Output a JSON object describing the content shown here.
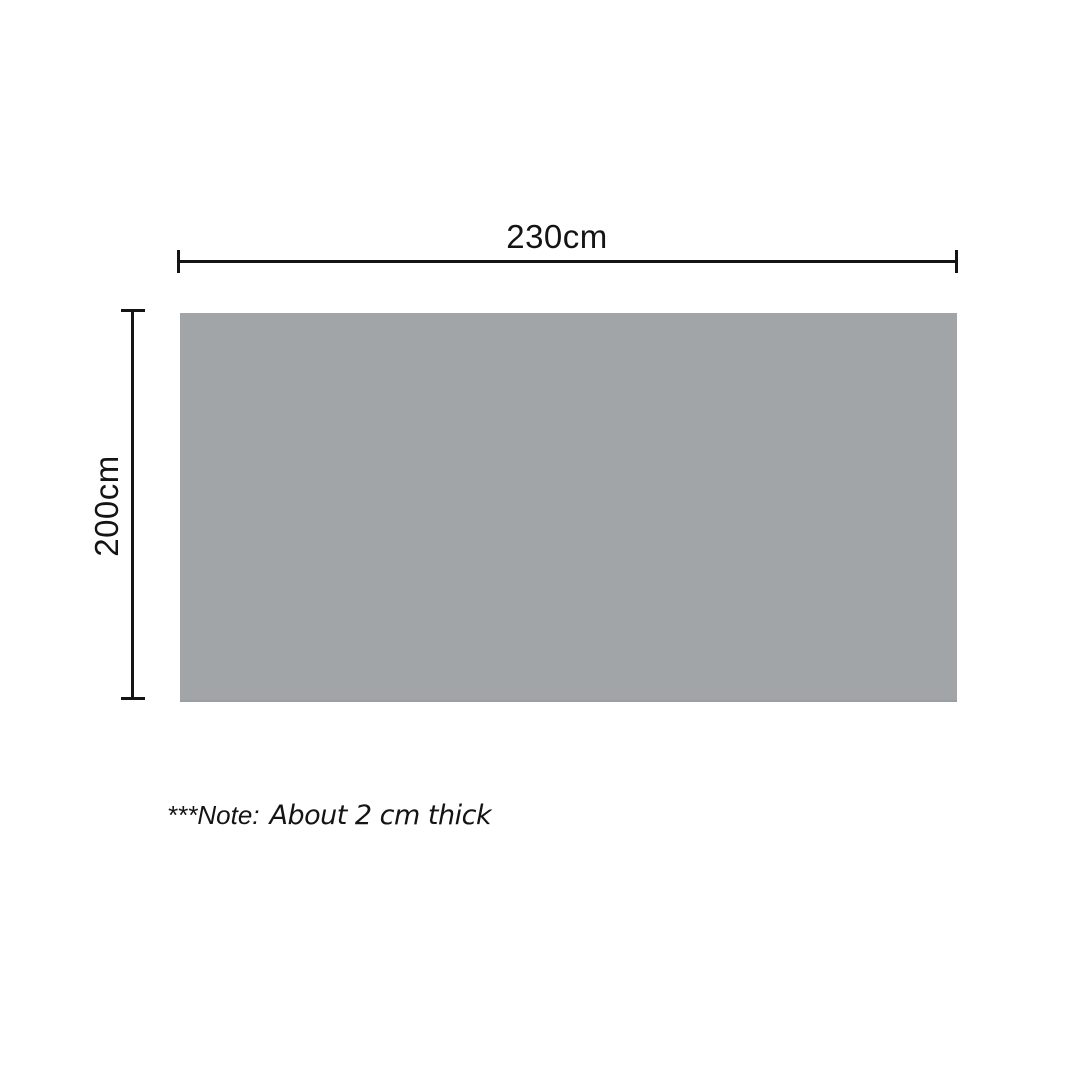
{
  "diagram": {
    "title": "product-dimension-diagram",
    "width_dimension": {
      "label": "230cm"
    },
    "height_dimension": {
      "label": "200cm"
    },
    "note": {
      "prefix": "***Note:",
      "text": "About 2 cm thick"
    },
    "colors": {
      "panel_fill": "#a1a5a8",
      "panel_bottom_edge": "#9a9ea1",
      "dimension_line": "#141414",
      "text": "#141414",
      "background": "#ffffff"
    }
  }
}
